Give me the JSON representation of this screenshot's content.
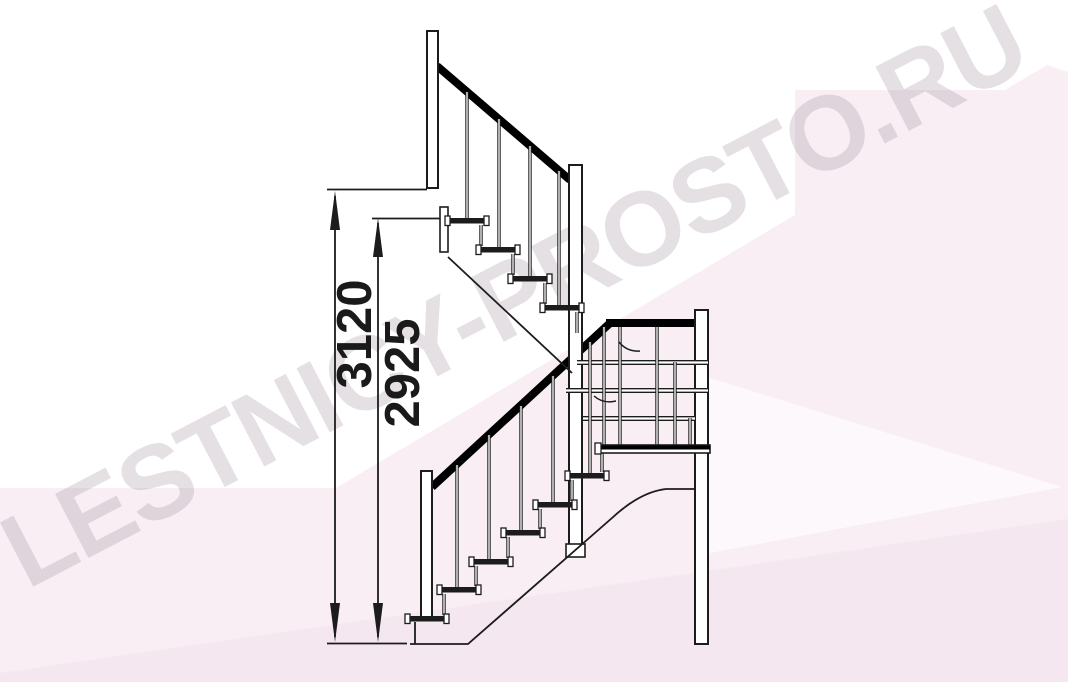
{
  "diagram": {
    "type": "staircase-side-elevation-drawing",
    "watermark": "LESTNICY-PROSTO.RU",
    "dimensions": [
      {
        "id": "overall-rise",
        "value": "3120"
      },
      {
        "id": "rise-to-top-tread",
        "value": "2925"
      }
    ],
    "colors": {
      "line": "#1c1c1c",
      "rail": "#000000",
      "fill": "#ffffff",
      "background_pink": "#f8eef4",
      "watermark_gray": "#ded8dd"
    }
  }
}
